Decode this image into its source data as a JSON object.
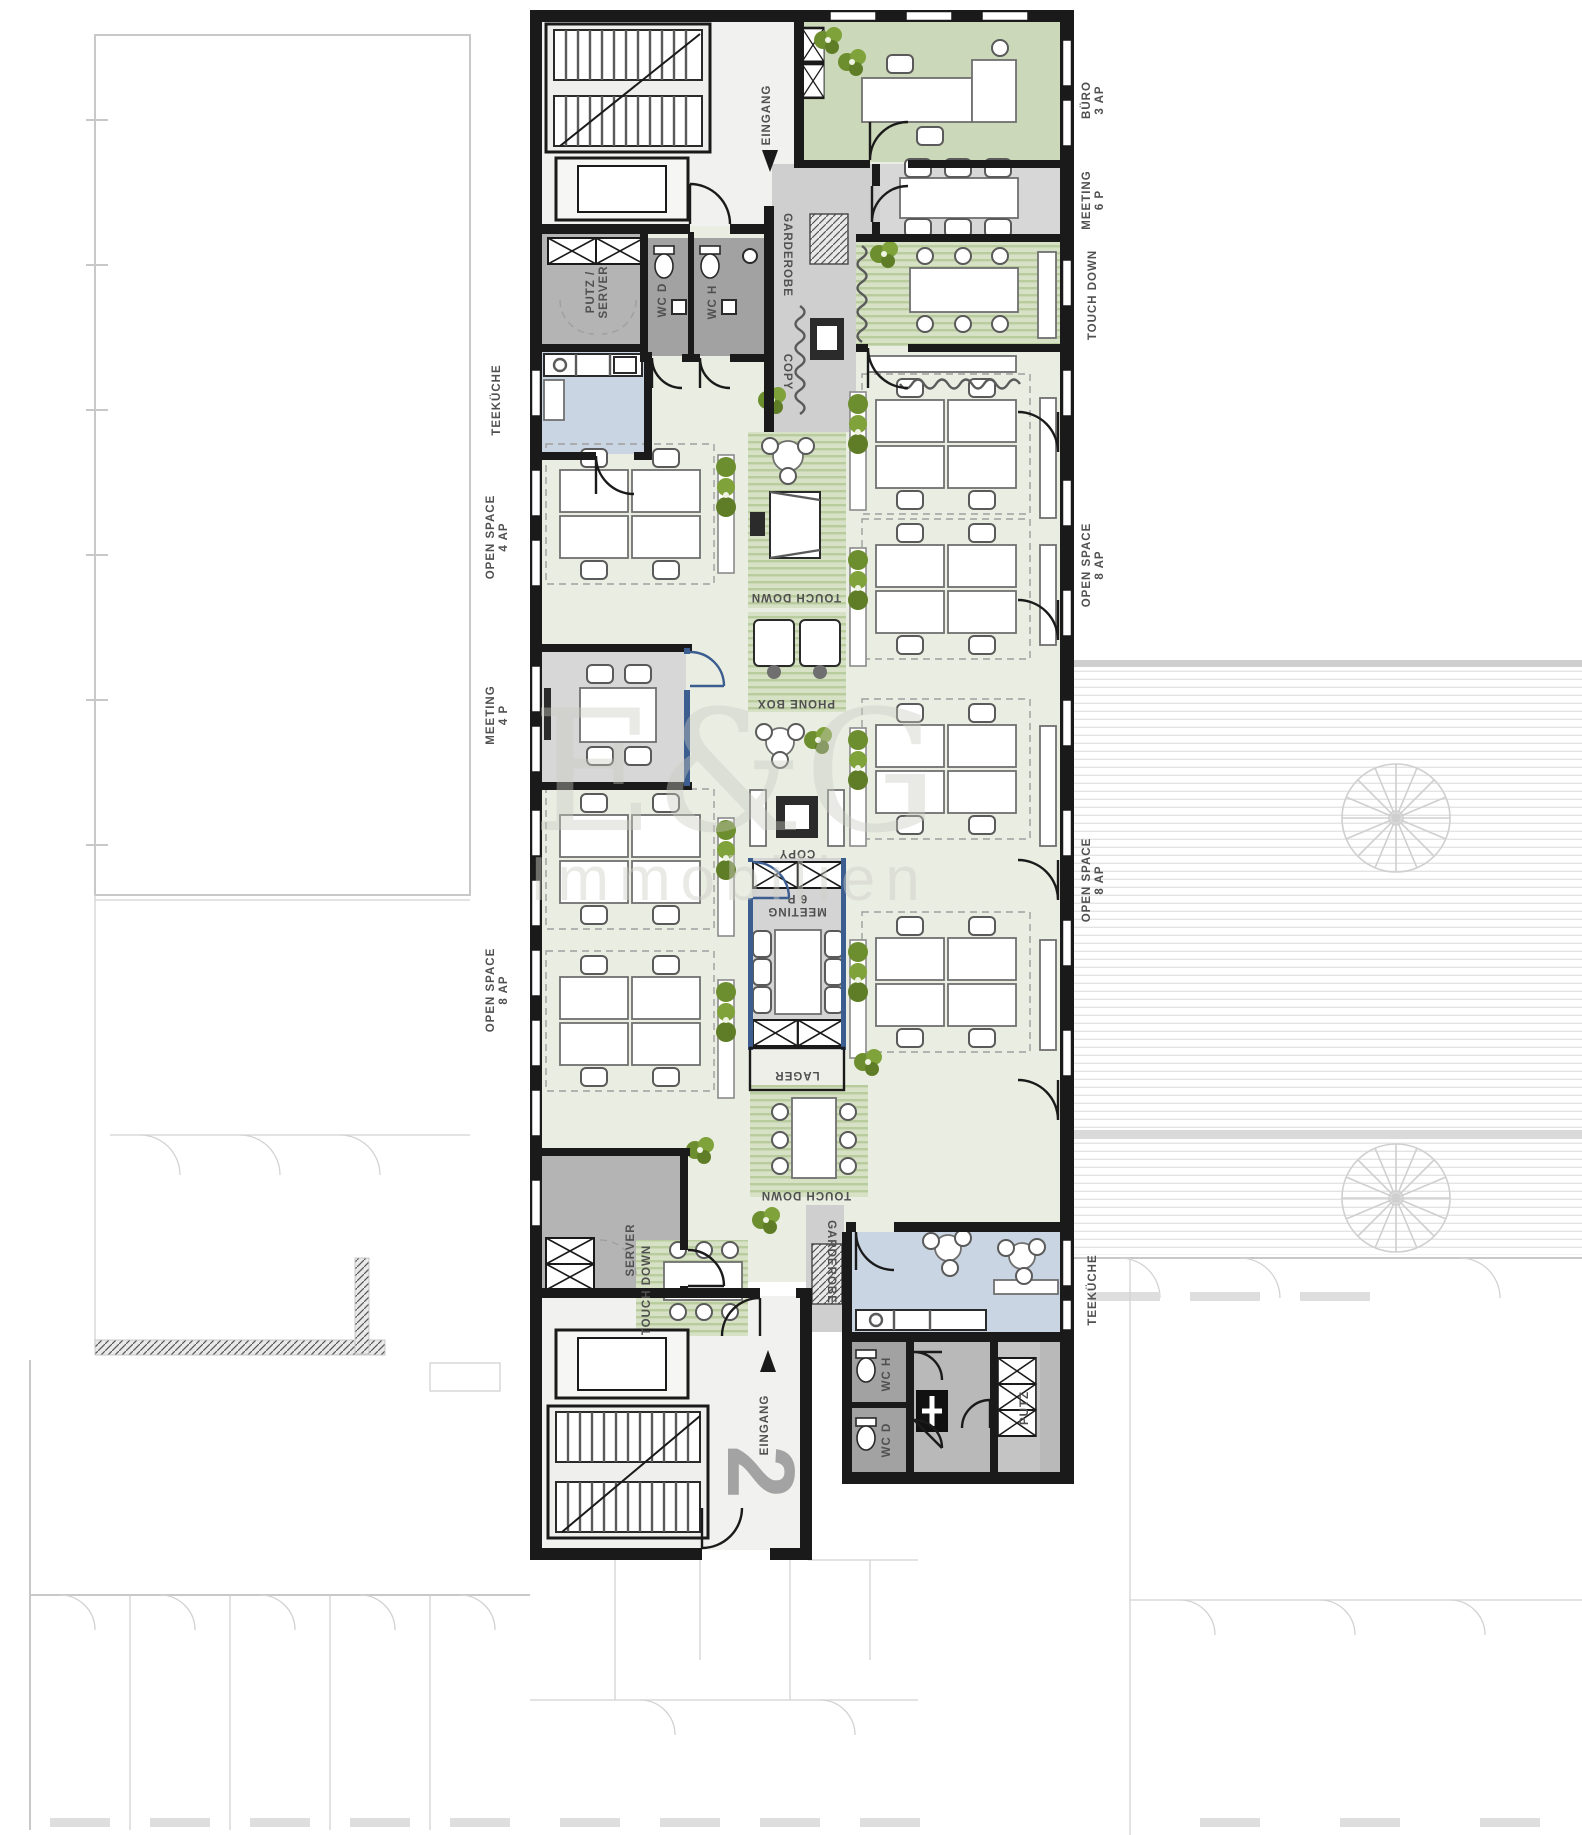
{
  "plan": {
    "type": "office-floor-plan",
    "floor_number": "2",
    "watermark": {
      "line1": "E&G",
      "line2": "Immobilien"
    },
    "labels_left": [
      {
        "l1": "TEEKÜCHE",
        "l2": ""
      },
      {
        "l1": "OPEN SPACE",
        "l2": "4 AP"
      },
      {
        "l1": "MEETING",
        "l2": "4 P"
      },
      {
        "l1": "OPEN SPACE",
        "l2": "8 AP"
      }
    ],
    "labels_right": [
      {
        "l1": "BÜRO",
        "l2": "3 AP"
      },
      {
        "l1": "MEETING",
        "l2": "6 P"
      },
      {
        "l1": "TOUCH DOWN",
        "l2": ""
      },
      {
        "l1": "OPEN SPACE",
        "l2": "8 AP"
      },
      {
        "l1": "OPEN SPACE",
        "l2": "8 AP"
      },
      {
        "l1": "TEEKÜCHE",
        "l2": ""
      }
    ],
    "rooms": {
      "eingang_top": "EINGANG",
      "putz_server_l1": "PUTZ /",
      "putz_server_l2": "SERVER",
      "wc_d_top": "WC D",
      "wc_h_top": "WC H",
      "garderobe_top": "GARDEROBE",
      "copy_top": "COPY",
      "touch_down_mid": "TOUCH DOWN",
      "phone_box": "PHONE BOX",
      "copy_mid": "COPY",
      "meeting_mid_l1": "MEETING",
      "meeting_mid_l2": "6 P",
      "lager": "LAGER",
      "touch_down_bottom_right": "TOUCH DOWN",
      "touch_down_bottom_left": "TOUCH DOWN",
      "server_bottom": "SERVER",
      "garderobe_bottom": "GARDEROBE",
      "wc_h_bottom": "WC H",
      "wc_d_bottom": "WC D",
      "putz_bottom": "PUTZ",
      "eingang_bottom": "EINGANG"
    },
    "colors": {
      "wall": "#1a1a1a",
      "floor": "#eaeee2",
      "room_green": "#ccd8ba",
      "stripe_light": "#d7e1c5",
      "stripe_dark": "#b9cc9d",
      "gray_room": "#b4b4b4",
      "gray_dark": "#a2a2a2",
      "gray_light": "#d7d7d7",
      "corridor_gray": "#cfcfcf",
      "blue_room": "#c9d5e2",
      "glass_blue": "#3c5d8f",
      "plant_green": "#6d8e2e",
      "context_gray": "#c8c8c8",
      "label_gray": "#505050"
    }
  }
}
